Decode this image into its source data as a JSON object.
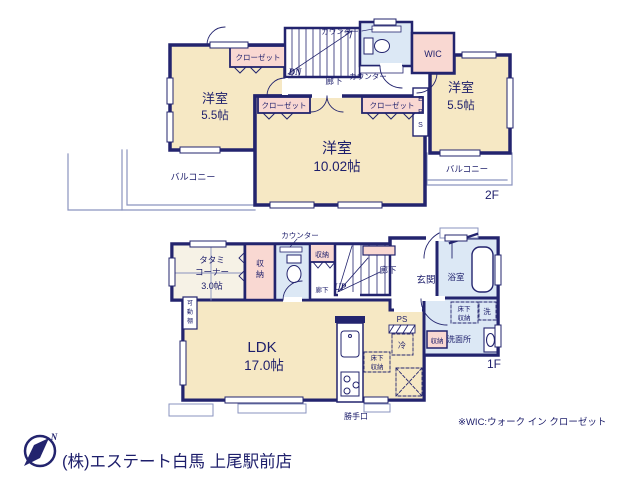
{
  "floor2": {
    "floor_label": "2F",
    "room_west": {
      "name": "洋室",
      "size": "5.5帖"
    },
    "room_east": {
      "name": "洋室",
      "size": "5.5帖"
    },
    "room_main": {
      "name": "洋室",
      "size": "10.02帖"
    },
    "closet": "クローゼット",
    "wic": "WIC",
    "eps": "EPS",
    "hallway": "廊下",
    "counter": "カウンター",
    "down": "DN",
    "balcony": "バルコニー"
  },
  "floor1": {
    "floor_label": "1F",
    "tatami_line1": "タタミ",
    "tatami_line2": "コーナー",
    "tatami_size": "3.0帖",
    "storage": "収納",
    "counter": "カウンター",
    "hallway": "廊下",
    "up": "UP",
    "entrance": "玄関",
    "bath": "浴室",
    "washroom": "洗面所",
    "underfloor_line1": "床下",
    "underfloor_line2": "収納",
    "washer": "洗",
    "fridge": "冷",
    "ps": "PS",
    "ldk": "LDK",
    "ldk_size": "17.0帖",
    "back_door": "勝手口",
    "movable_shelf": "可動棚"
  },
  "footer": {
    "north": "N",
    "company": "(株)エステート白馬 上尾駅前店",
    "wic_note": "※WIC:ウォーク イン クローゼット"
  },
  "colors": {
    "wall": "#23246e",
    "room_cream": "#f6e8c4",
    "closet_pink": "#f9d8d2",
    "wet_blue": "#dce8f5",
    "tatami": "#f6f2e6",
    "thin_line": "#8a93bf",
    "company_gray": "#c8c8c9"
  }
}
